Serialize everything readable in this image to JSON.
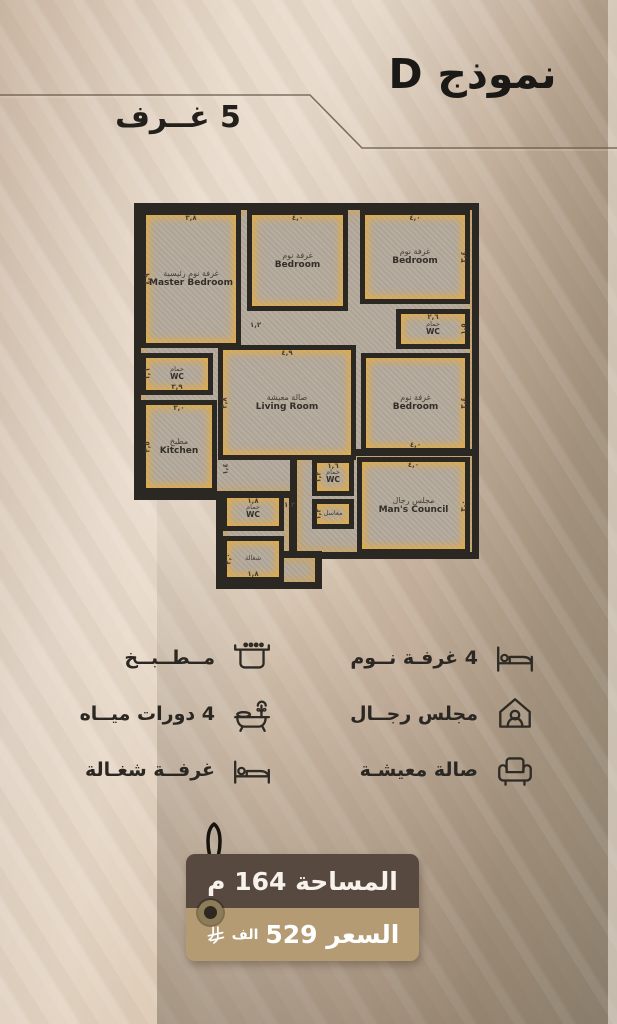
{
  "title": "نموذج D",
  "badge": "5 غــرف",
  "plan": {
    "rooms": [
      {
        "ar": "غرفة نوم رئيسية",
        "en": "Master Bedroom",
        "dim_top": "٣,٨",
        "dim_left": "٤,٩"
      },
      {
        "ar": "غرفة نوم",
        "en": "Bedroom",
        "dim_top": "٤,٠"
      },
      {
        "ar": "غرفة نوم",
        "en": "Bedroom",
        "dim_top": "٤,٠",
        "dim_right": "٣,٤"
      },
      {
        "ar": "حمام",
        "en": "WC",
        "dim_left": "١,٦",
        "dim_bottom": "٣,٩"
      },
      {
        "ar": "مطبخ",
        "en": "Kitchen",
        "dim_top": "٣,٠",
        "dim_left": "٣,٥"
      },
      {
        "ar": "صالة معيشة",
        "en": "Living Room",
        "dim_top": "٤,٩",
        "dim_left": "٣,٨"
      },
      {
        "ar": "حمام",
        "en": "WC",
        "dim_top": "٢,٦",
        "dim_right": "١,٥"
      },
      {
        "ar": "غرفة نوم",
        "en": "Bedroom",
        "dim_right": "٣,٤",
        "dim_bottom": "٤,٠"
      },
      {
        "ar": "حمام",
        "en": "WC",
        "dim_top": "١,٦",
        "dim_left": "١,٣"
      },
      {
        "ar": "مغاسل",
        "en": "",
        "dim_left": "١,٢"
      },
      {
        "ar": "مجلس رجال",
        "en": "Man's Council",
        "dim_top": "٤,٠",
        "dim_right": "٣,٠"
      },
      {
        "ar": "حمام",
        "en": "WC",
        "dim_top": "١,٨"
      },
      {
        "ar": "شغالة",
        "en": "",
        "dim_left": "٢,٠",
        "dim_bottom": "١,٨"
      }
    ],
    "hall_dims": [
      "١,٢",
      "١,٤",
      "١,٣"
    ]
  },
  "legend": {
    "left": [
      {
        "label": "مــطــبــخ",
        "icon": "stove-icon"
      },
      {
        "label": "4 دورات ميــاه",
        "icon": "bathtub-icon"
      },
      {
        "label": "غرفــة شغـالة",
        "icon": "maid-bed-icon"
      }
    ],
    "right": [
      {
        "label": "4 غرفـة نــوم",
        "icon": "bed-icon"
      },
      {
        "label": "مجلس رجــال",
        "icon": "majlis-icon"
      },
      {
        "label": "صالة معيشـة",
        "icon": "armchair-icon"
      }
    ]
  },
  "tag": {
    "area": "المساحة 164 م",
    "price": "السعر 529",
    "price_unit": "الف"
  },
  "colors": {
    "accent_yellow": "#e9ac38",
    "wall": "#2b2723",
    "tag_top": "#57493f",
    "tag_bottom": "#b49b73",
    "background": "#d8c5b1"
  }
}
